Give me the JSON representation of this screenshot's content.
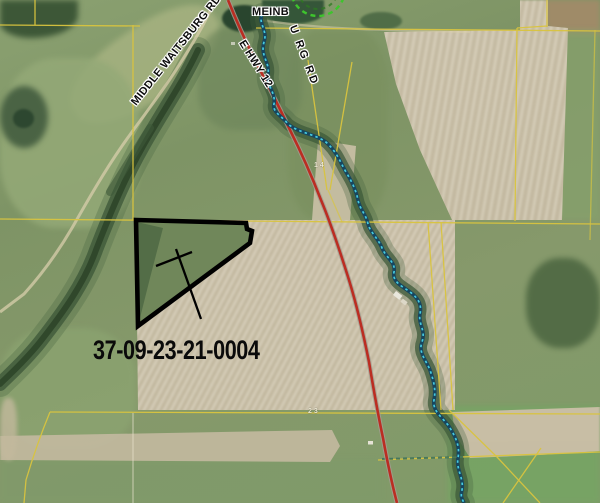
{
  "labels": {
    "parcel_id": "37-09-23-21-0004",
    "road_middle_waitsburg": "MIDDLE WAITSBURG RD",
    "road_meinburg_upper": "MEINB",
    "road_meinburg_lower": "U RG RD",
    "road_e_hwy12": "E HWY 12",
    "marker_section_north": "14",
    "marker_section_south": "23"
  },
  "colors": {
    "section_line": "#d9c43f",
    "highway": "#bb2d22",
    "stream": "#45cbe0",
    "stream_casing": "#17465e",
    "parcel_highlight": "#000000",
    "irrigation_circle": "#3ec42d"
  }
}
